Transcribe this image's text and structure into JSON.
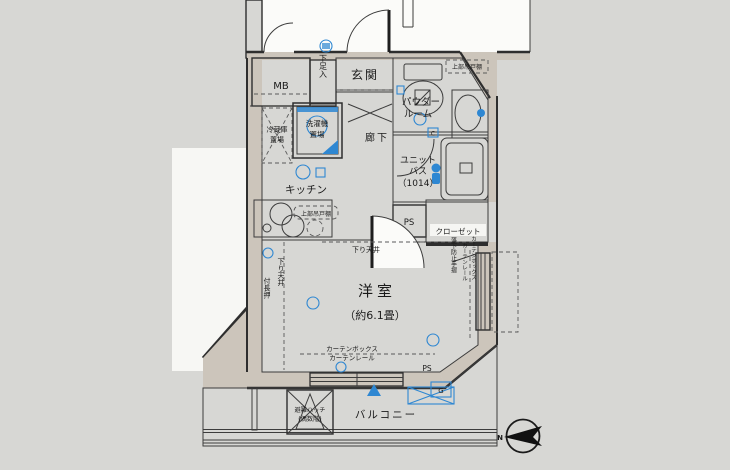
{
  "floorplan": {
    "colors": {
      "background": "#d7d7d4",
      "wall_fill": "#ccc5bb",
      "wall_line": "#2e2e2e",
      "flooring_base": "#aab6d1",
      "flooring_stripe": "#8c9bbd",
      "wet_area": "#cde3f4",
      "white_area": "#fbfbf9",
      "accent_blue": "#2e87d2"
    },
    "labels": {
      "mb": "MB",
      "shoe_box": "下足入",
      "entrance": "玄関",
      "powder_cabinet": "上部吊戸棚",
      "powder1": "パウダー",
      "powder2": "ルーム",
      "bath1": "ユニット",
      "bath2": "バス",
      "bath3": "（1014）",
      "ps_top": "PS",
      "closet": "クローゼット",
      "fridge1": "冷蔵庫",
      "fridge2": "置場",
      "washer1": "洗濯機",
      "washer2": "置場",
      "hallway": "廊下",
      "kitchen": "キッチン",
      "kitchen_cabinet": "上部吊戸棚",
      "dropped_ceiling_h": "下り天井",
      "dropped_ceiling_v": "下り天井",
      "nageshi": "付長押",
      "room": "洋室",
      "room_size": "（約6.1畳）",
      "handrail": "落下防止手摺",
      "curtain_rail_v": "カーテンレール",
      "curtain_box_v": "カーテンボックス",
      "curtain_box_h": "カーテンボックス",
      "curtain_rail_h": "カーテンレール",
      "ps_bottom": "PS",
      "hatch1": "避難ハッチ",
      "hatch2": "(偶数階)",
      "balcony": "バルコニー",
      "north": "N",
      "g_unit": "G",
      "c_symbol": "C"
    }
  }
}
